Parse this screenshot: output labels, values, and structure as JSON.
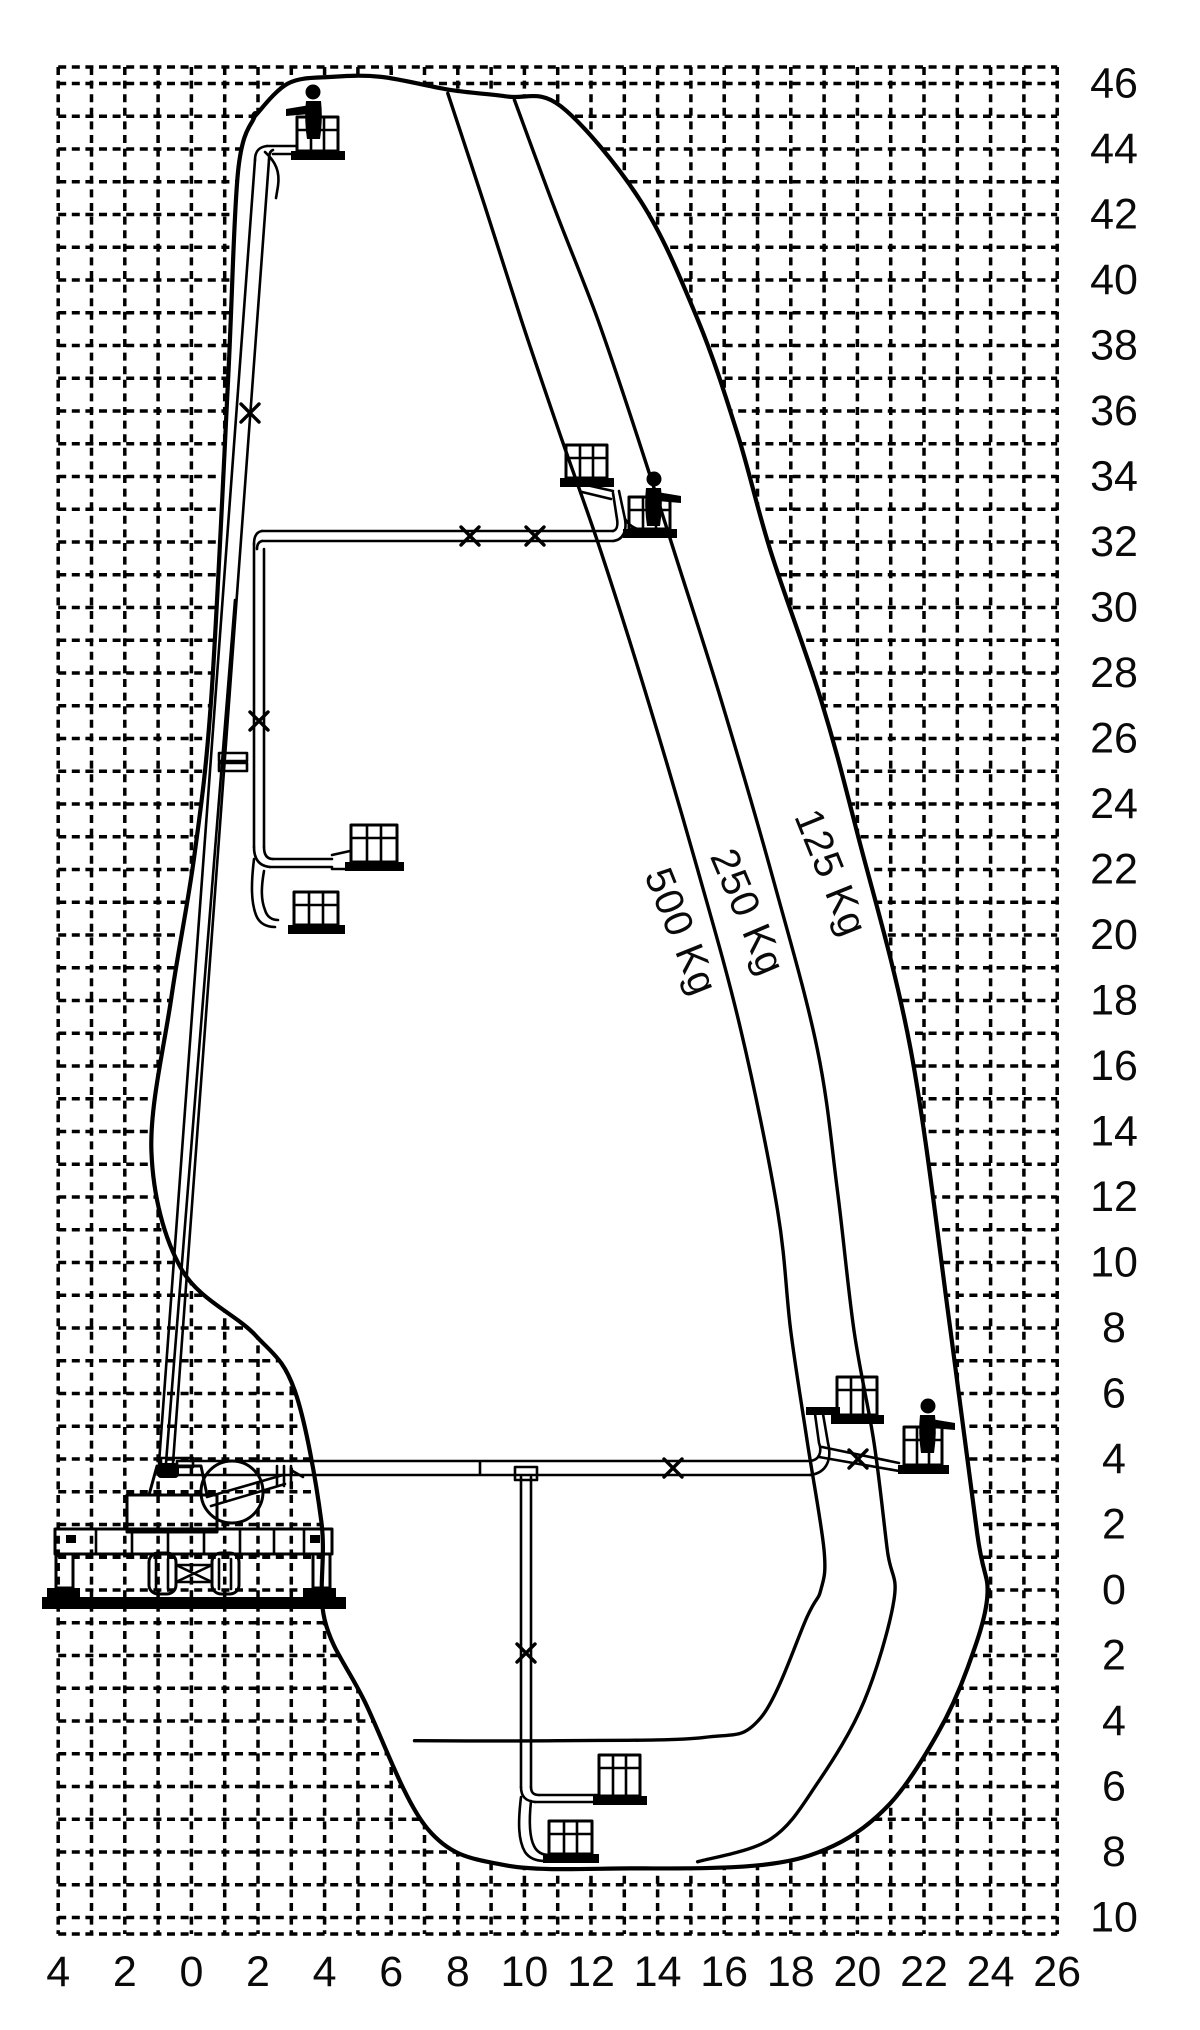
{
  "chart_data": {
    "type": "line",
    "title": "",
    "xlabel": "",
    "ylabel": "",
    "grid": {
      "x_min": -4,
      "x_max": 26,
      "y_min": -10,
      "y_max": 46,
      "step_m": 1,
      "style": "dashed"
    },
    "axis_mapping": {
      "x0": 191.4,
      "px_per_m_x": 33.3,
      "y0": 1590,
      "px_per_m_y": 32.75,
      "grid_left": 58.2,
      "grid_right": 1057.2,
      "grid_top": 67,
      "grid_bottom": 1934
    },
    "x_ticks": [
      {
        "v": -4,
        "label": "4"
      },
      {
        "v": -2,
        "label": "2"
      },
      {
        "v": 0,
        "label": "0"
      },
      {
        "v": 2,
        "label": "2"
      },
      {
        "v": 4,
        "label": "4"
      },
      {
        "v": 6,
        "label": "6"
      },
      {
        "v": 8,
        "label": "8"
      },
      {
        "v": 10,
        "label": "10"
      },
      {
        "v": 12,
        "label": "12"
      },
      {
        "v": 14,
        "label": "14"
      },
      {
        "v": 16,
        "label": "16"
      },
      {
        "v": 18,
        "label": "18"
      },
      {
        "v": 20,
        "label": "20"
      },
      {
        "v": 22,
        "label": "22"
      },
      {
        "v": 24,
        "label": "24"
      },
      {
        "v": 26,
        "label": "26"
      }
    ],
    "y_ticks": [
      {
        "v": 46,
        "label": "46"
      },
      {
        "v": 44,
        "label": "44"
      },
      {
        "v": 42,
        "label": "42"
      },
      {
        "v": 40,
        "label": "40"
      },
      {
        "v": 38,
        "label": "38"
      },
      {
        "v": 36,
        "label": "36"
      },
      {
        "v": 34,
        "label": "34"
      },
      {
        "v": 32,
        "label": "32"
      },
      {
        "v": 30,
        "label": "30"
      },
      {
        "v": 28,
        "label": "28"
      },
      {
        "v": 26,
        "label": "26"
      },
      {
        "v": 24,
        "label": "24"
      },
      {
        "v": 22,
        "label": "22"
      },
      {
        "v": 20,
        "label": "20"
      },
      {
        "v": 18,
        "label": "18"
      },
      {
        "v": 16,
        "label": "16"
      },
      {
        "v": 14,
        "label": "14"
      },
      {
        "v": 12,
        "label": "12"
      },
      {
        "v": 10,
        "label": "10"
      },
      {
        "v": 8,
        "label": "8"
      },
      {
        "v": 6,
        "label": "6"
      },
      {
        "v": 4,
        "label": "4"
      },
      {
        "v": 2,
        "label": "2"
      },
      {
        "v": 0,
        "label": "0"
      },
      {
        "v": -2,
        "label": "2"
      },
      {
        "v": -4,
        "label": "4"
      },
      {
        "v": -6,
        "label": "6"
      },
      {
        "v": -8,
        "label": "8"
      },
      {
        "v": -10,
        "label": "10"
      }
    ],
    "series": {
      "envelope_outer_125": [
        [
          1.9,
          45.0
        ],
        [
          2.9,
          46.0
        ],
        [
          4.2,
          46.2
        ],
        [
          5.7,
          46.2
        ],
        [
          7.8,
          45.8
        ],
        [
          9.5,
          45.6
        ],
        [
          11.1,
          45.3
        ],
        [
          13.5,
          42.4
        ],
        [
          15.2,
          38.8
        ],
        [
          16.4,
          35.3
        ],
        [
          17.4,
          31.7
        ],
        [
          18.9,
          27.2
        ],
        [
          20.0,
          23.1
        ],
        [
          21.6,
          16.5
        ],
        [
          22.8,
          7.9
        ],
        [
          23.6,
          1.7
        ],
        [
          23.9,
          -0.2
        ],
        [
          23.3,
          -2.4
        ],
        [
          22.4,
          -4.4
        ],
        [
          21.0,
          -6.5
        ],
        [
          19.3,
          -7.8
        ],
        [
          17.1,
          -8.4
        ],
        [
          13.2,
          -8.5
        ]
      ],
      "envelope_left_boundary": [
        [
          1.9,
          45.0
        ],
        [
          1.4,
          43.3
        ],
        [
          1.1,
          36.9
        ],
        [
          0.6,
          27.3
        ],
        [
          0.1,
          22.5
        ],
        [
          -0.6,
          18.1
        ],
        [
          -1.2,
          13.4
        ],
        [
          -0.3,
          9.8
        ],
        [
          1.9,
          7.8
        ],
        [
          3.1,
          6.1
        ],
        [
          3.9,
          2.1
        ],
        [
          4.0,
          -0.9
        ],
        [
          5.2,
          -3.4
        ],
        [
          7.1,
          -7.3
        ],
        [
          9.4,
          -8.4
        ]
      ],
      "limit_250": [
        [
          9.7,
          45.5
        ],
        [
          10.9,
          42.2
        ],
        [
          12.2,
          38.8
        ],
        [
          13.4,
          35.2
        ],
        [
          14.5,
          31.7
        ],
        [
          15.9,
          27.2
        ],
        [
          17.5,
          21.6
        ],
        [
          18.8,
          16.5
        ],
        [
          19.4,
          12.2
        ],
        [
          19.9,
          7.9
        ],
        [
          20.5,
          4.5
        ],
        [
          20.9,
          1.2
        ],
        [
          21.1,
          -0.3
        ],
        [
          20.2,
          -3.4
        ],
        [
          18.8,
          -5.9
        ],
        [
          17.4,
          -7.6
        ],
        [
          15.2,
          -8.3
        ]
      ],
      "limit_500": [
        [
          7.7,
          45.7
        ],
        [
          8.8,
          42.3
        ],
        [
          9.9,
          38.8
        ],
        [
          11.1,
          35.2
        ],
        [
          12.3,
          31.7
        ],
        [
          13.7,
          27.2
        ],
        [
          15.2,
          22.0
        ],
        [
          16.5,
          17.1
        ],
        [
          17.6,
          11.6
        ],
        [
          18.0,
          7.9
        ],
        [
          18.5,
          4.5
        ],
        [
          19.0,
          1.2
        ],
        [
          18.9,
          0.0
        ],
        [
          18.5,
          -0.8
        ],
        [
          17.1,
          -3.9
        ],
        [
          15.4,
          -4.5
        ],
        [
          11.0,
          -4.6
        ],
        [
          6.7,
          -4.6
        ]
      ]
    },
    "load_labels": [
      {
        "text": "500 Kg",
        "x_m": 14.7,
        "y_m": 20.1,
        "angle": 68
      },
      {
        "text": "250 Kg",
        "x_m": 16.7,
        "y_m": 20.7,
        "angle": 67
      },
      {
        "text": "125 Kg",
        "x_m": 19.2,
        "y_m": 21.9,
        "angle": 68
      }
    ],
    "legend_position": "on-curves",
    "max_height_m": 46,
    "max_outreach_m": 24,
    "max_depth_m": -8.5
  }
}
